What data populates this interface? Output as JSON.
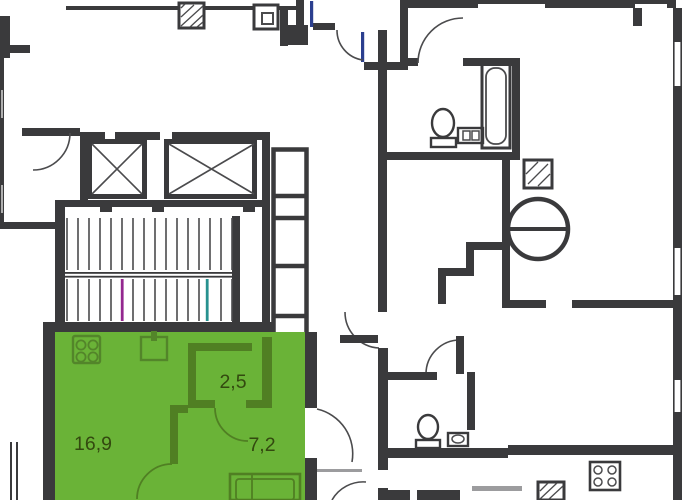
{
  "colors": {
    "background": "#ffffff",
    "wall": "#3a3a3c",
    "wall_thin": "#4b4b4d",
    "wall_light": "#9c9c9e",
    "unit_fill": "#6ab337",
    "unit_wall": "#507f23",
    "unit_icon": "#53852a",
    "unit_label": "#33490f",
    "door_accent": "#2b3f8f",
    "stair_marker_magenta": "#93278f",
    "stair_marker_teal": "#27918f"
  },
  "floor_plan": {
    "selected_unit": {
      "rooms": [
        {
          "area_label": "16,9"
        },
        {
          "area_label": "2,5"
        },
        {
          "area_label": "7,2"
        }
      ],
      "fixtures": [
        "stove-icon",
        "sink-icon",
        "bathtub-icon"
      ]
    },
    "building_core": {
      "features": [
        "elevator-shaft-icon",
        "elevator-shaft-icon",
        "staircase-icon",
        "vent-shaft-icon",
        "utility-shaft-icon"
      ]
    },
    "neighbor_fixtures": [
      "bathtub-icon",
      "toilet-icon",
      "washbasin-icon",
      "stool-icon",
      "round-table-icon",
      "toilet-icon",
      "washbasin-icon",
      "stove-icon"
    ]
  }
}
